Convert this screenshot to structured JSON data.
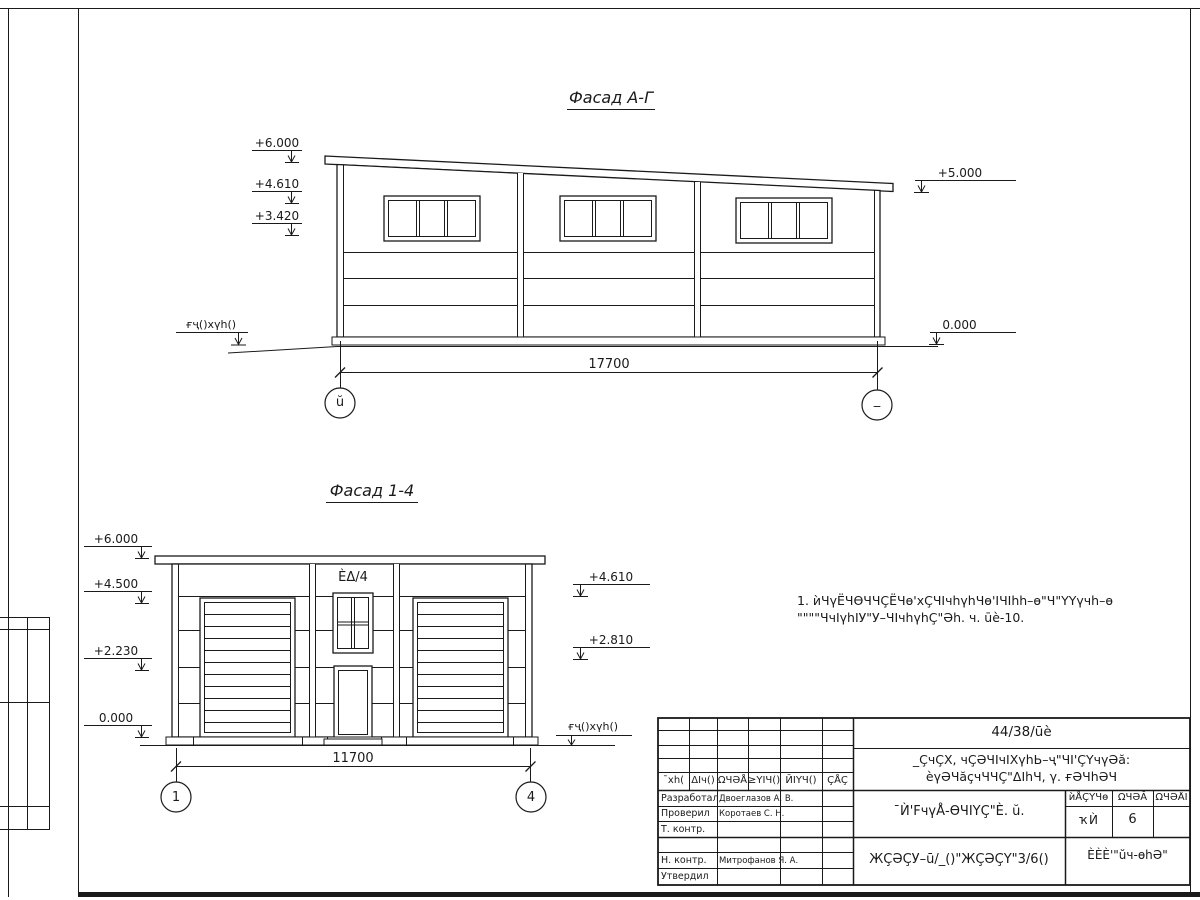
{
  "sheet": {
    "facade_ag": {
      "title": "Фасад А-Г",
      "dim": "17700",
      "axis_left": "ŭ",
      "axis_right": "_",
      "marks": {
        "m6": "+6.000",
        "m461": "+4.610",
        "m342": "+3.420",
        "m5": "+5.000",
        "m0": "0.000"
      },
      "ground": "ғҷ()хүh()"
    },
    "facade_14": {
      "title": "Фасад 1-4",
      "dim": "11700",
      "axis_left": "1",
      "axis_right": "4",
      "window_label": "ÈΔ/4",
      "marks": {
        "m6": "+6.000",
        "m45": "+4.500",
        "m223": "+2.230",
        "m0": "0.000",
        "m461": "+4.610",
        "m281": "+2.810"
      },
      "ground": "ғҷ()хүh()"
    },
    "note": {
      "line1": "1. ѝЧүЁЧѲЧЧÇЁЧѳ'хÇЧIчhүhЧѳ'IЧIhh–ѳ\"Ч\"ҮҮүчh–ѳ",
      "line2": "\"\"\"\"ЧчIүhIУ\"У–ЧIчhүhÇ\"Әh. ч. ūè-10."
    },
    "titleblock": {
      "doc_number": "44/38/ūè",
      "project_line1": "_ÇчÇХ, чÇӘЧIчIХүhЬ–ҷ\"ЧI'ÇҮчүӘă:",
      "project_line2": "èүӘЧăçчЧЧÇ\"ΔIhЧ, γ. ғӘЧhӘЧ",
      "sheet_title": "¯Ѝ'FчүÅ-ѲЧIҮÇ\"È. ŭ.",
      "doc_code": "ЖÇӘÇУ–ū/_()\"ЖÇӘÇҮ\"3/6()",
      "company": "ÈÈÈ'\"ŭч-ѳhӘ\"",
      "cols": {
        "c1": "¯хh(",
        "c2": "ΔIч()",
        "c3": "ΩЧӘÅ",
        "c4": "≥ҮІЧ()",
        "c5": "ЙІҮЧ()",
        "c6": "ÇÅÇ"
      },
      "stage": {
        "h1": "ѝÅÇҮЧѳ",
        "h2": "ΩЧӘĂ",
        "h3": "ΩЧӘÅI",
        "v1": "ҡЍ",
        "v2": "6",
        "v3": ""
      },
      "rows": [
        {
          "role": "Разработал",
          "name": "Двоеглазов А. В."
        },
        {
          "role": "Проверил",
          "name": "Коротаев С. Н."
        },
        {
          "role": "Т. контр.",
          "name": ""
        },
        {
          "role": "",
          "name": ""
        },
        {
          "role": "Н. контр.",
          "name": "Митрофанов Я. А."
        },
        {
          "role": "Утвердил",
          "name": ""
        }
      ]
    }
  }
}
